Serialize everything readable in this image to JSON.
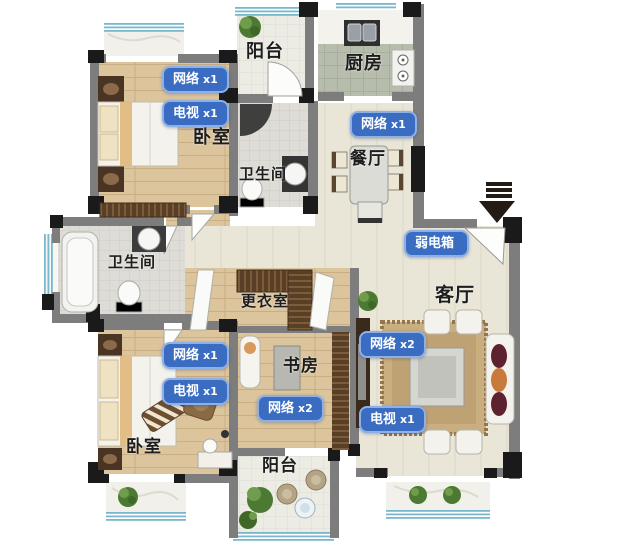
{
  "plan_title": "apartment-floor-plan",
  "colors": {
    "wall": "#7d7d7d",
    "wall_block": "#1a1a1a",
    "tag_bg": "#3a6cc2",
    "tag_border": "#8fb0e4",
    "tag_text": "#ffffff",
    "room_text": "#1d1d1d",
    "floor_wood": "#dcc49c",
    "floor_cream_tile": "#e9e6d8",
    "floor_bath_tile": "#dedcd6",
    "floor_kitchen_tile": "#b7bdac",
    "floor_balcony_tile": "#ececе4",
    "window_blue": "#79b8cc",
    "plant_green": "#4c7a33"
  },
  "icons": {
    "entrance": "entrance-arrow-down"
  },
  "rooms": [
    {
      "name": "balcony-top",
      "label": "阳台"
    },
    {
      "name": "kitchen",
      "label": "厨房"
    },
    {
      "name": "bedroom-top",
      "label": "卧室"
    },
    {
      "name": "bathroom-top",
      "label": "卫生间"
    },
    {
      "name": "dining-room",
      "label": "餐厅"
    },
    {
      "name": "bathroom-left",
      "label": "卫生间"
    },
    {
      "name": "dressing-room",
      "label": "更衣室"
    },
    {
      "name": "living-room",
      "label": "客厅"
    },
    {
      "name": "study",
      "label": "书房"
    },
    {
      "name": "bedroom-bottom",
      "label": "卧室"
    },
    {
      "name": "balcony-bottom",
      "label": "阳台"
    }
  ],
  "tags": [
    {
      "name": "bedroom-top-network",
      "device": "网络",
      "count": "x1"
    },
    {
      "name": "bedroom-top-tv",
      "device": "电视",
      "count": "x1"
    },
    {
      "name": "dining-network",
      "device": "网络",
      "count": "x1"
    },
    {
      "name": "weak-current-box",
      "device": "弱电箱",
      "count": ""
    },
    {
      "name": "bedroom-bottom-network",
      "device": "网络",
      "count": "x1"
    },
    {
      "name": "bedroom-bottom-tv",
      "device": "电视",
      "count": "x1"
    },
    {
      "name": "study-network",
      "device": "网络",
      "count": "x2"
    },
    {
      "name": "living-network",
      "device": "网络",
      "count": "x2"
    },
    {
      "name": "living-tv",
      "device": "电视",
      "count": "x1"
    }
  ]
}
